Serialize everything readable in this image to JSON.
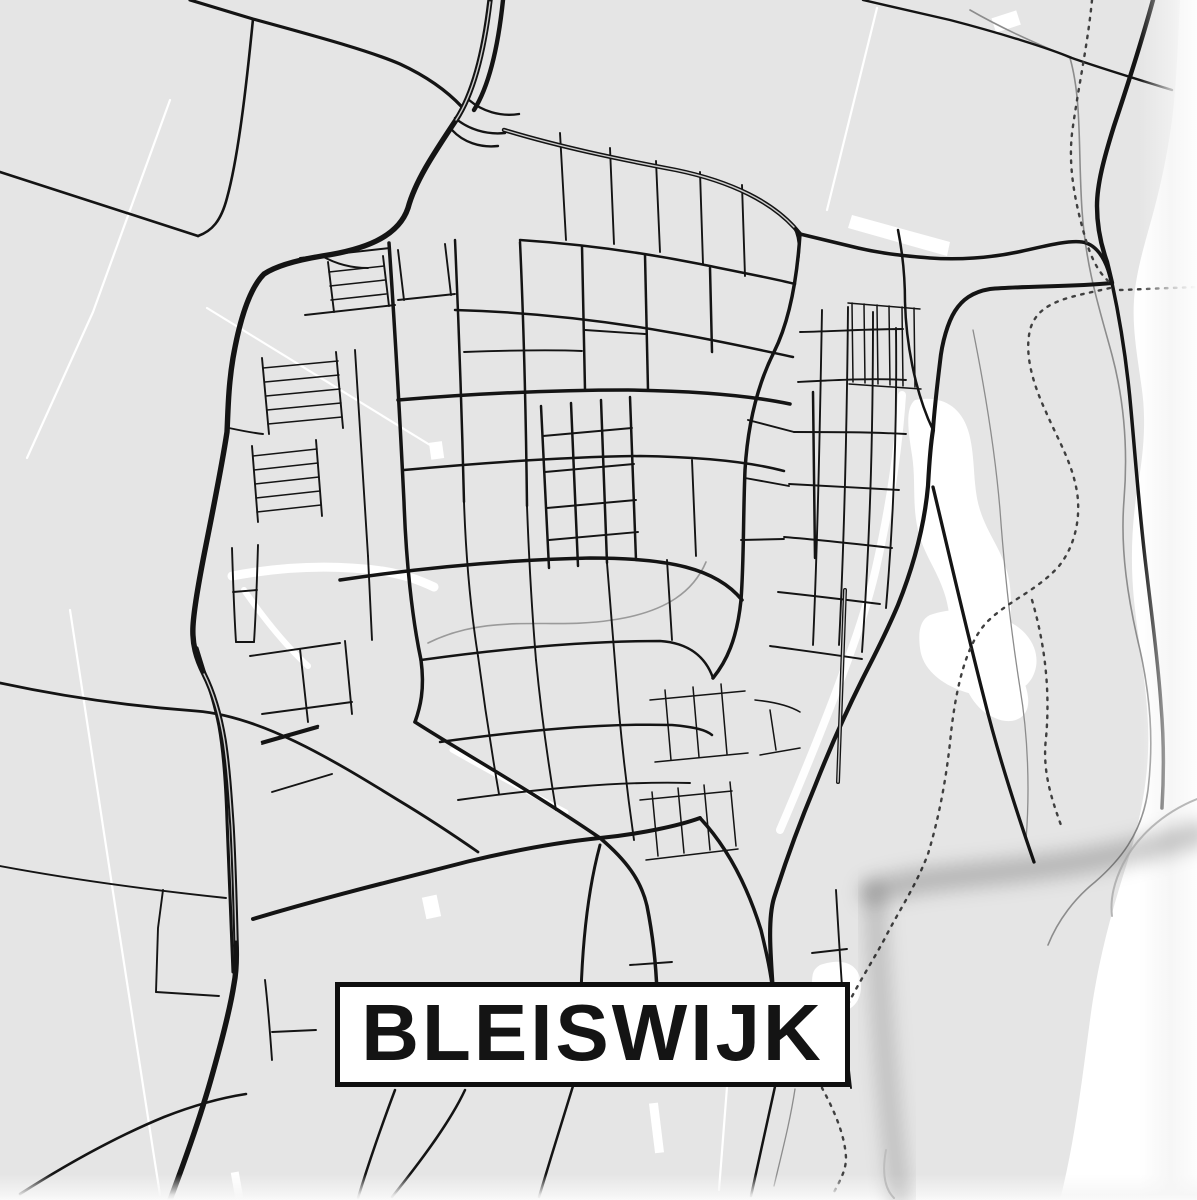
{
  "poster": {
    "title": "BLEISWIJK",
    "type_label": "city-map-poster"
  },
  "colors": {
    "bg": "#e5e5e5",
    "road": "#141414",
    "white": "#ffffff",
    "grayline": "#8c8c8c",
    "dash": "#3f3f3f",
    "plate_border": "#0f0f0f",
    "curl_shadow": "rgba(0,0,0,0.20)"
  },
  "map": {
    "style": "black-and-white street map",
    "features": {
      "highway": "bold curved road from top centre to bottom left",
      "town_grid": "dense street grid in centre",
      "municipal_boundary": "dotted line along right side",
      "water": "white wavy areas along right edge"
    }
  }
}
